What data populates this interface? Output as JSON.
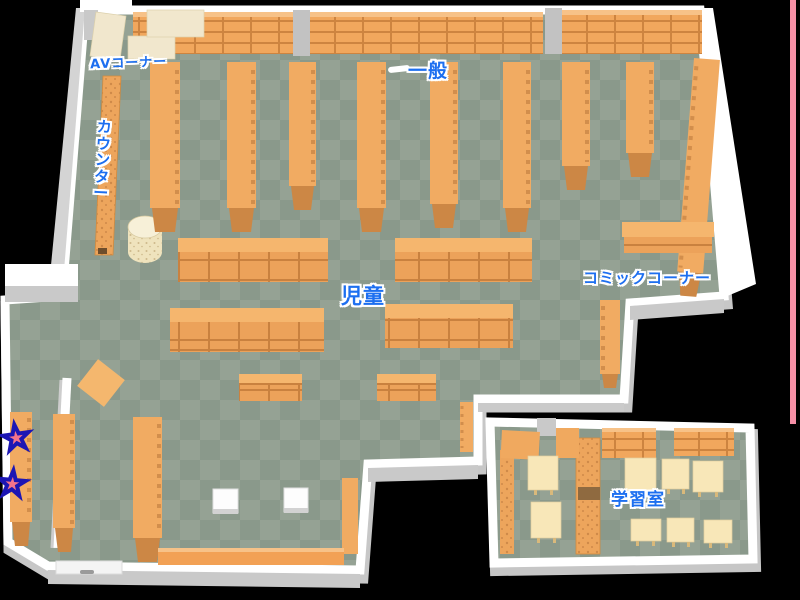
{
  "map": {
    "type": "library-floor-map",
    "areas": {
      "av_corner": "AVコーナー",
      "general": "一般",
      "counter": "カウンター",
      "children": "児童",
      "comic_corner": "コミックコーナー",
      "study_room": "学習室"
    },
    "markers": {
      "symbol": "★",
      "count": 2,
      "fill": "#f4738b",
      "outline": "#1c16b4"
    },
    "palette": {
      "background": "#000000",
      "floor_light": "#95a294",
      "floor_dark": "#8a998b",
      "wall": "#ffffff",
      "wall_shadow": "#c7c7c7",
      "shelf": "#f1ab62",
      "shelf_cap": "#cc8745",
      "shelf_grid_line": "#cd8440",
      "table_cream": "#f8e7b8",
      "av_cream": "#f1e7cd",
      "label_blue": "#1d6ff0",
      "edge_accent_pink": "#f58fa6"
    }
  }
}
